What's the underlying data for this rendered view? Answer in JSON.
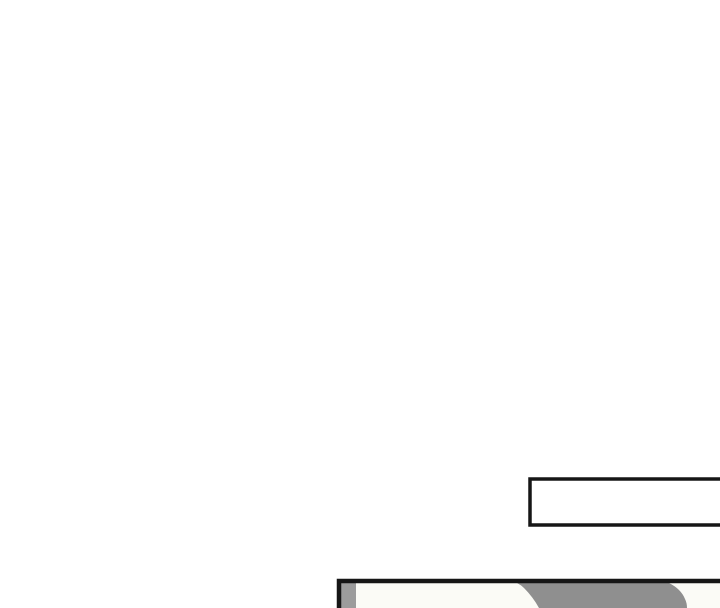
{
  "colors": {
    "page_bg": "#ffffff",
    "ink": "#161616",
    "panel_bg": "#fbfbf6",
    "bubble_fill": "#ffffff",
    "figure_gray": "#8f8f8f",
    "figure_gray_light": "#9c9c9c"
  },
  "speech_bubble": {
    "text": ""
  }
}
